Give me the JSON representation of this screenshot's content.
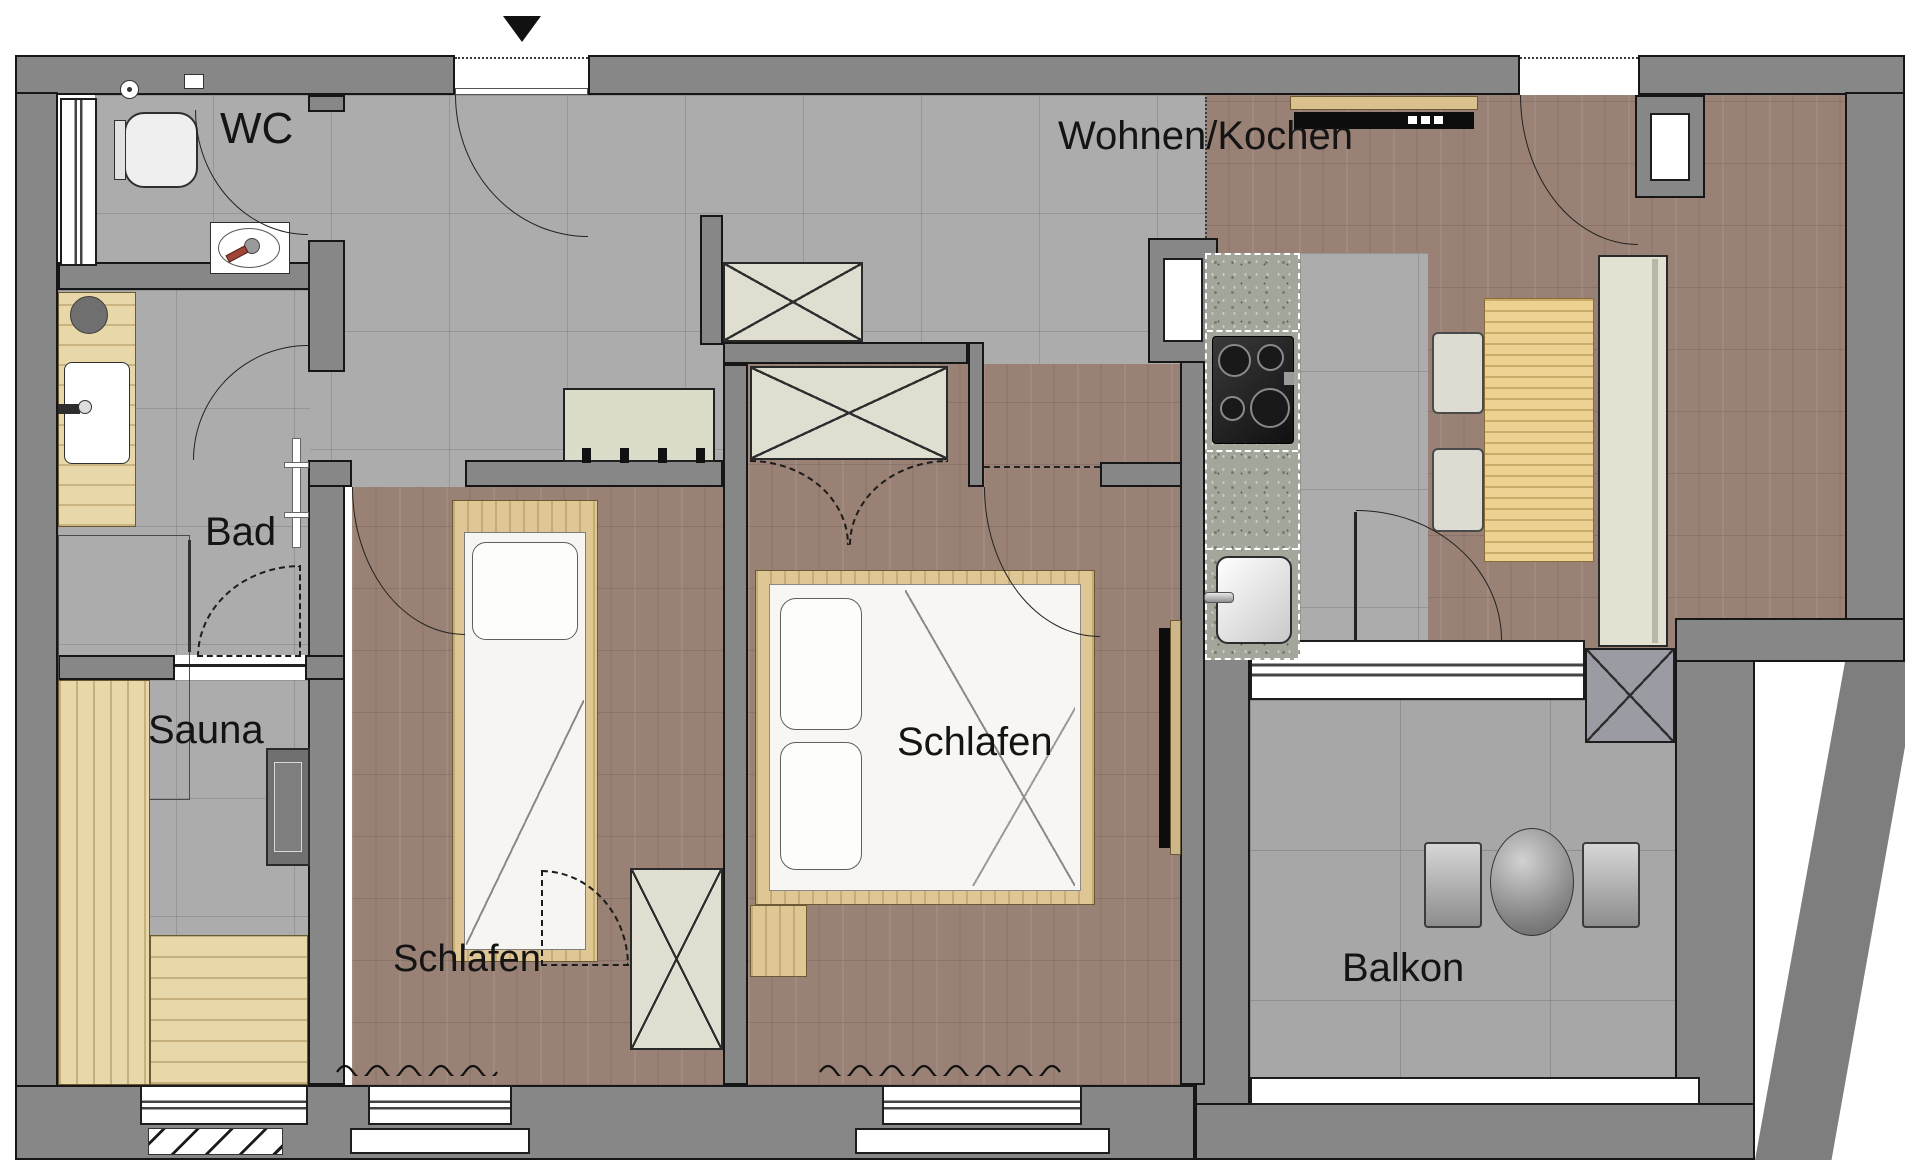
{
  "title": "Wohnungsgrundriss",
  "rooms": [
    {
      "id": "wc",
      "label": "WC"
    },
    {
      "id": "bad",
      "label": "Bad"
    },
    {
      "id": "sauna",
      "label": "Sauna"
    },
    {
      "id": "schlafen_links",
      "label": "Schlafen"
    },
    {
      "id": "schlafen_mitte",
      "label": "Schlafen"
    },
    {
      "id": "wohnen_kochen",
      "label": "Wohnen/Kochen"
    },
    {
      "id": "balkon",
      "label": "Balkon"
    }
  ],
  "icons": {
    "entrance_marker": "down-triangle"
  },
  "fixtures": [
    "toilet",
    "toilet-paper-holder",
    "washbasin",
    "vanity",
    "stool",
    "shower",
    "drain",
    "towel-rail",
    "sauna-bench-left",
    "sauna-bench-bottom",
    "sauna-heater",
    "sauna-glass-door",
    "single-bed",
    "double-bed",
    "pillow",
    "nightstand",
    "wardrobe",
    "folding-door",
    "coat-bench",
    "kitchen-counter",
    "cooktop",
    "kitchen-sink",
    "tv-lowboard",
    "tv",
    "installation-shaft",
    "dining-table",
    "dining-chair",
    "tall-sideboard",
    "balcony-table",
    "balcony-chair",
    "radiator",
    "window",
    "door",
    "entrance"
  ],
  "colors": {
    "wall": "#878787",
    "tile_floor": "#acacac",
    "wood_floor": "#9a8175",
    "furniture_wood": "#dfc795",
    "furniture_cream": "#e0ded0",
    "granite_counter": "#a3a69a",
    "line": "#1a1a1a"
  }
}
